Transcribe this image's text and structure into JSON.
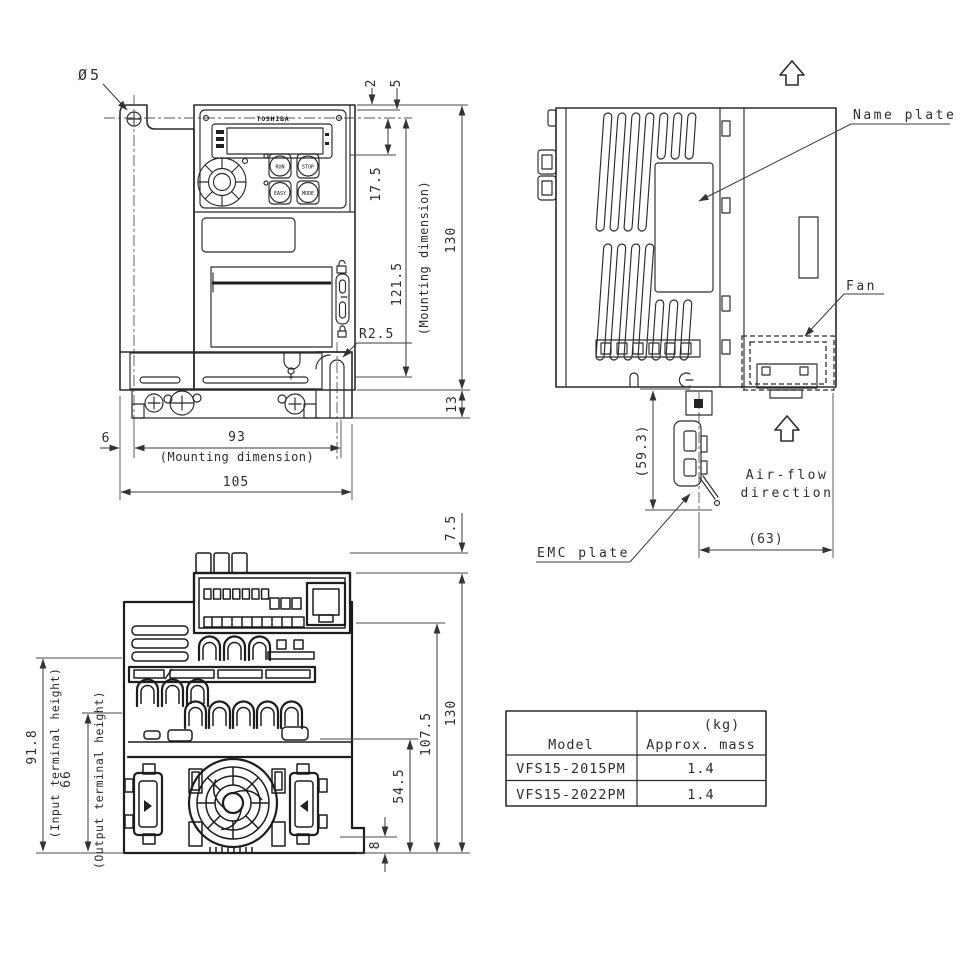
{
  "front_view": {
    "keypad": {
      "brand": "TOSHIBA",
      "btn_run": "RUN",
      "btn_stop": "STOP",
      "btn_easy": "EASY",
      "btn_mode": "MODE"
    },
    "dims": {
      "hole_diameter": "Ø5",
      "offset_2": "2",
      "offset_5": "5",
      "keypad_center": "17.5",
      "mounting_height": "121.5",
      "mounting_height_note": "(Mounting dimension)",
      "overall_height": "130",
      "base_height": "13",
      "corner_radius": "R2.5",
      "hole_offset": "6",
      "mounting_width": "93",
      "mounting_width_note": "(Mounting dimension)",
      "overall_width": "105"
    }
  },
  "side_view": {
    "labels": {
      "name_plate": "Name plate",
      "fan": "Fan",
      "emc_plate": "EMC plate",
      "air_flow_line1": "Air-flow",
      "air_flow_line2": "direction"
    },
    "dims": {
      "emc_plate_height": "(59.3)",
      "emc_plate_depth": "(63)"
    }
  },
  "bottom_view": {
    "dims": {
      "top_block_height": "7.5",
      "overall_height": "130",
      "upper_height": "107.5",
      "lower_height": "54.5",
      "foot_height": "8",
      "input_terminal_height": "91.8",
      "input_terminal_note": "(Input terminal height)",
      "output_terminal_height": "66",
      "output_terminal_note": "(Output terminal height)"
    }
  },
  "mass_table": {
    "header": {
      "model": "Model",
      "unit": "(kg)",
      "mass": "Approx. mass"
    },
    "rows": [
      {
        "model": "VFS15-2015PM",
        "mass": "1.4"
      },
      {
        "model": "VFS15-2022PM",
        "mass": "1.4"
      }
    ]
  }
}
